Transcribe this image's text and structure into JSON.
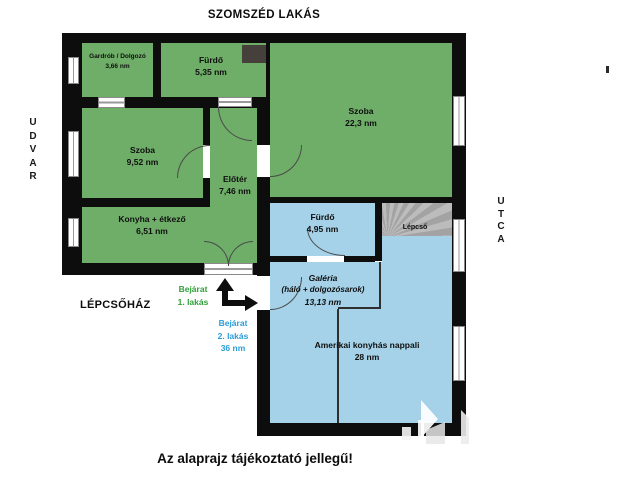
{
  "labels": {
    "neighbor": "SZOMSZÉD LAKÁS",
    "udvar": "U\nD\nV\nA\nR",
    "utca": "U\nT\nC\nA",
    "stairwell": "LÉPCSŐHÁZ",
    "disclaimer": "Az alaprajz tájékoztató jellegű!"
  },
  "rooms": {
    "gardrob": {
      "name": "Gardrób / Dolgozó",
      "area": "3,66 nm"
    },
    "furdo1": {
      "name": "Fürdő",
      "area": "5,35 nm"
    },
    "szoba_nagy": {
      "name": "Szoba",
      "area": "22,3 nm"
    },
    "szoba_kis": {
      "name": "Szoba",
      "area": "9,52 nm"
    },
    "eloter": {
      "name": "Előtér",
      "area": "7,46 nm"
    },
    "konyha": {
      "name": "Konyha + étkező",
      "area": "6,51 nm"
    },
    "furdo2": {
      "name": "Fürdő",
      "area": "4,95 nm"
    },
    "lepcso": {
      "name": "Lépcső"
    },
    "galeria": {
      "name": "Galéria",
      "name2": "(háló + dolgozósarok)",
      "area": "13,13 nm"
    },
    "nappali": {
      "name": "Amerikai konyhás nappali",
      "area": "28 nm"
    }
  },
  "entrances": {
    "apt1": {
      "line1": "Bejárat",
      "line2": "1. lakás"
    },
    "apt2": {
      "line1": "Bejárat",
      "line2": "2. lakás",
      "line3": "36 nm"
    }
  },
  "colors": {
    "apartment1_floor": "#6fae68",
    "apartment2_floor": "#a5d2e8",
    "stairs": "#aeaeae",
    "wall": "#0d0d0d",
    "entrance1_text": "#2fa03a",
    "entrance2_text": "#2b9cd8"
  }
}
